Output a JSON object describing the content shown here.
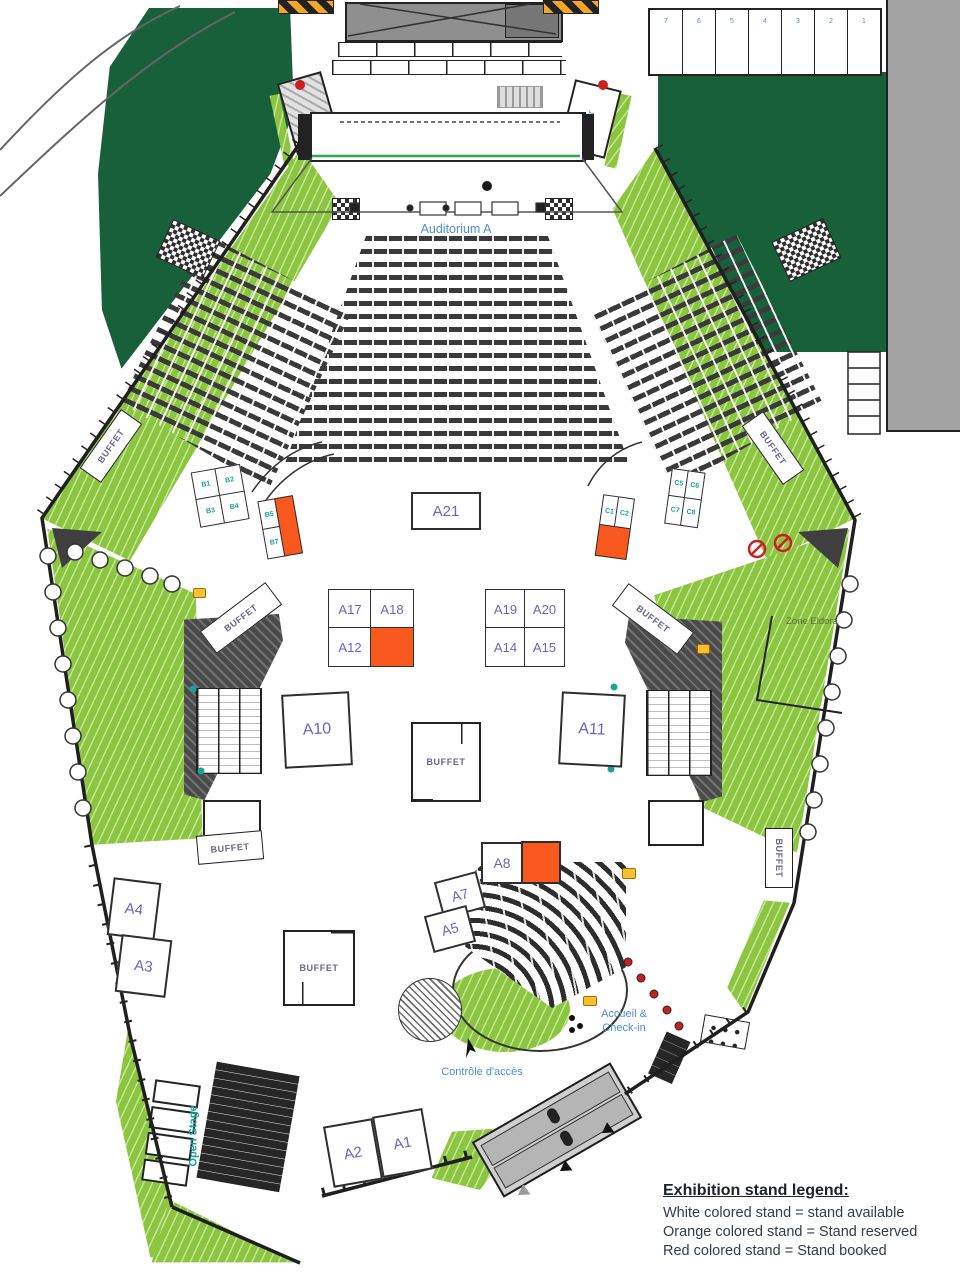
{
  "labels": {
    "auditorium": "Auditorium A",
    "lift": "LIFT",
    "buffet": "BUFFET",
    "zone_eldora": "Zone Eldora",
    "accueil": "Accueil & Check-in",
    "controle": "Contrôle d'accès",
    "open_stage": "Open Stage"
  },
  "bays": [
    "7",
    "6",
    "5",
    "4",
    "3",
    "2",
    "1"
  ],
  "stands": {
    "a1": "A1",
    "a2": "A2",
    "a3": "A3",
    "a4": "A4",
    "a5": "A5",
    "a7": "A7",
    "a8": "A8",
    "a10": "A10",
    "a11": "A11",
    "a12": "A12",
    "a14": "A14",
    "a15": "A15",
    "a17": "A17",
    "a18": "A18",
    "a19": "A19",
    "a20": "A20",
    "a21": "A21",
    "b1": "B1",
    "b2": "B2",
    "b3": "B3",
    "b4": "B4",
    "b5": "B5",
    "b7": "B7",
    "c1": "C1",
    "c2": "C2",
    "c5": "C5",
    "c6": "C6",
    "c7": "C7",
    "c8": "C8"
  },
  "legend": {
    "title": "Exhibition stand legend:",
    "items": [
      "White colored stand = stand available",
      "Orange colored stand = Stand reserved",
      "Red colored stand = Stand booked"
    ]
  },
  "colors": {
    "stand_available": "#FFFFFF",
    "stand_reserved": "#F9591E",
    "stand_booked": "#D42B1E",
    "lawn_dark": "#17603A",
    "lawn_light": "#8CC63F",
    "stand_label": "#6C63C4",
    "small_stand_label": "#17A398",
    "info_label": "#4E8FD0"
  }
}
